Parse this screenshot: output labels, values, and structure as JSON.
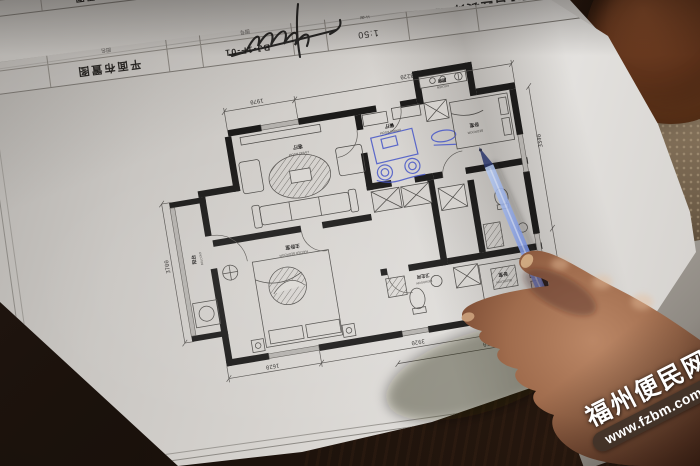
{
  "title_block": {
    "drawing_name": "平面布置图",
    "drawing_no": "BJ-1F-01",
    "scale": "1:50",
    "fields": {
      "name": "图名",
      "number": "图号",
      "scale": "比例",
      "date": "日期"
    }
  },
  "back_sheet": {
    "drawing_name": "平面布置图",
    "drawing_no": "BJ-1F-01"
  },
  "logo": {
    "company": "日匠装饰",
    "mark": "匠"
  },
  "watermark": {
    "site_name": "福州便民网",
    "site_url": "www.fzbm.com"
  },
  "plan": {
    "rooms": [
      {
        "cn": "客厅",
        "en": "LIVING ROOM"
      },
      {
        "cn": "餐厅",
        "en": "DINING ROOM"
      },
      {
        "cn": "阳台",
        "en": "BALCONY"
      },
      {
        "cn": "主卧室",
        "en": "MASTER BEDROOM"
      },
      {
        "cn": "卧室",
        "en": "BEDROOM"
      },
      {
        "cn": "卫生间",
        "en": "BATHROOM"
      },
      {
        "cn": "厨房",
        "en": "KITCHEN"
      }
    ],
    "dims": {
      "top1": "1970",
      "top2": "3220",
      "left": "3700",
      "bottom1": "1620",
      "bottom2": "3920",
      "bottom3": "2850",
      "right1": "3340",
      "right2": "1500"
    }
  },
  "objects": {
    "pen": "blue-ballpoint-pen",
    "hand": "right-hand-pointing",
    "teapot": "clay-teapot",
    "carpet": "carpet-edge",
    "table": "dark-wood-table",
    "signature": "handwritten-signature"
  },
  "colors": {
    "paper": "#d7d4d0",
    "ink": "#1a1a1a",
    "blue_pen": "#4656c8",
    "skin": "#a06c4d",
    "table_dark": "#1b120c",
    "carpet": "#8d7a62",
    "teapot": "#5a3019",
    "watermark_white": "#ffffff"
  }
}
